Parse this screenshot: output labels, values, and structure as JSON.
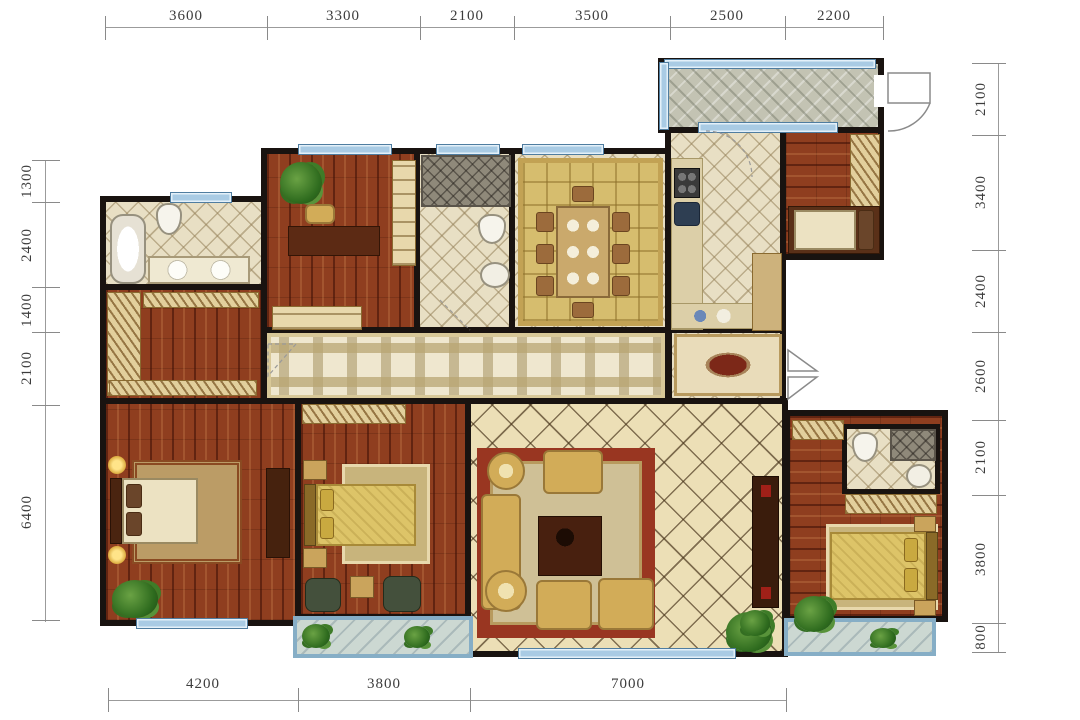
{
  "dimensions": {
    "top": [
      "3600",
      "3300",
      "2100",
      "3500",
      "2500",
      "2200"
    ],
    "right": [
      "2100",
      "3400",
      "2400",
      "2600",
      "2100",
      "3800",
      "800"
    ],
    "left": [
      "1300",
      "2400",
      "1400",
      "2100",
      "6400"
    ],
    "bottom": [
      "4200",
      "3800",
      "7000"
    ]
  },
  "colors": {
    "wall": "#191310",
    "wood_floor": "#8f3e1f",
    "cream_tile": "#e8dfc4",
    "living_tile": "#ecdfb6",
    "window_blue": "#a9cbe4",
    "balcony_blue": "#86aec6",
    "entry_mosaic": "#c3c3b3",
    "rug_gold": "#d6bd6e",
    "rug_red_border": "#993621",
    "sofa_gold": "#d2ac58"
  }
}
